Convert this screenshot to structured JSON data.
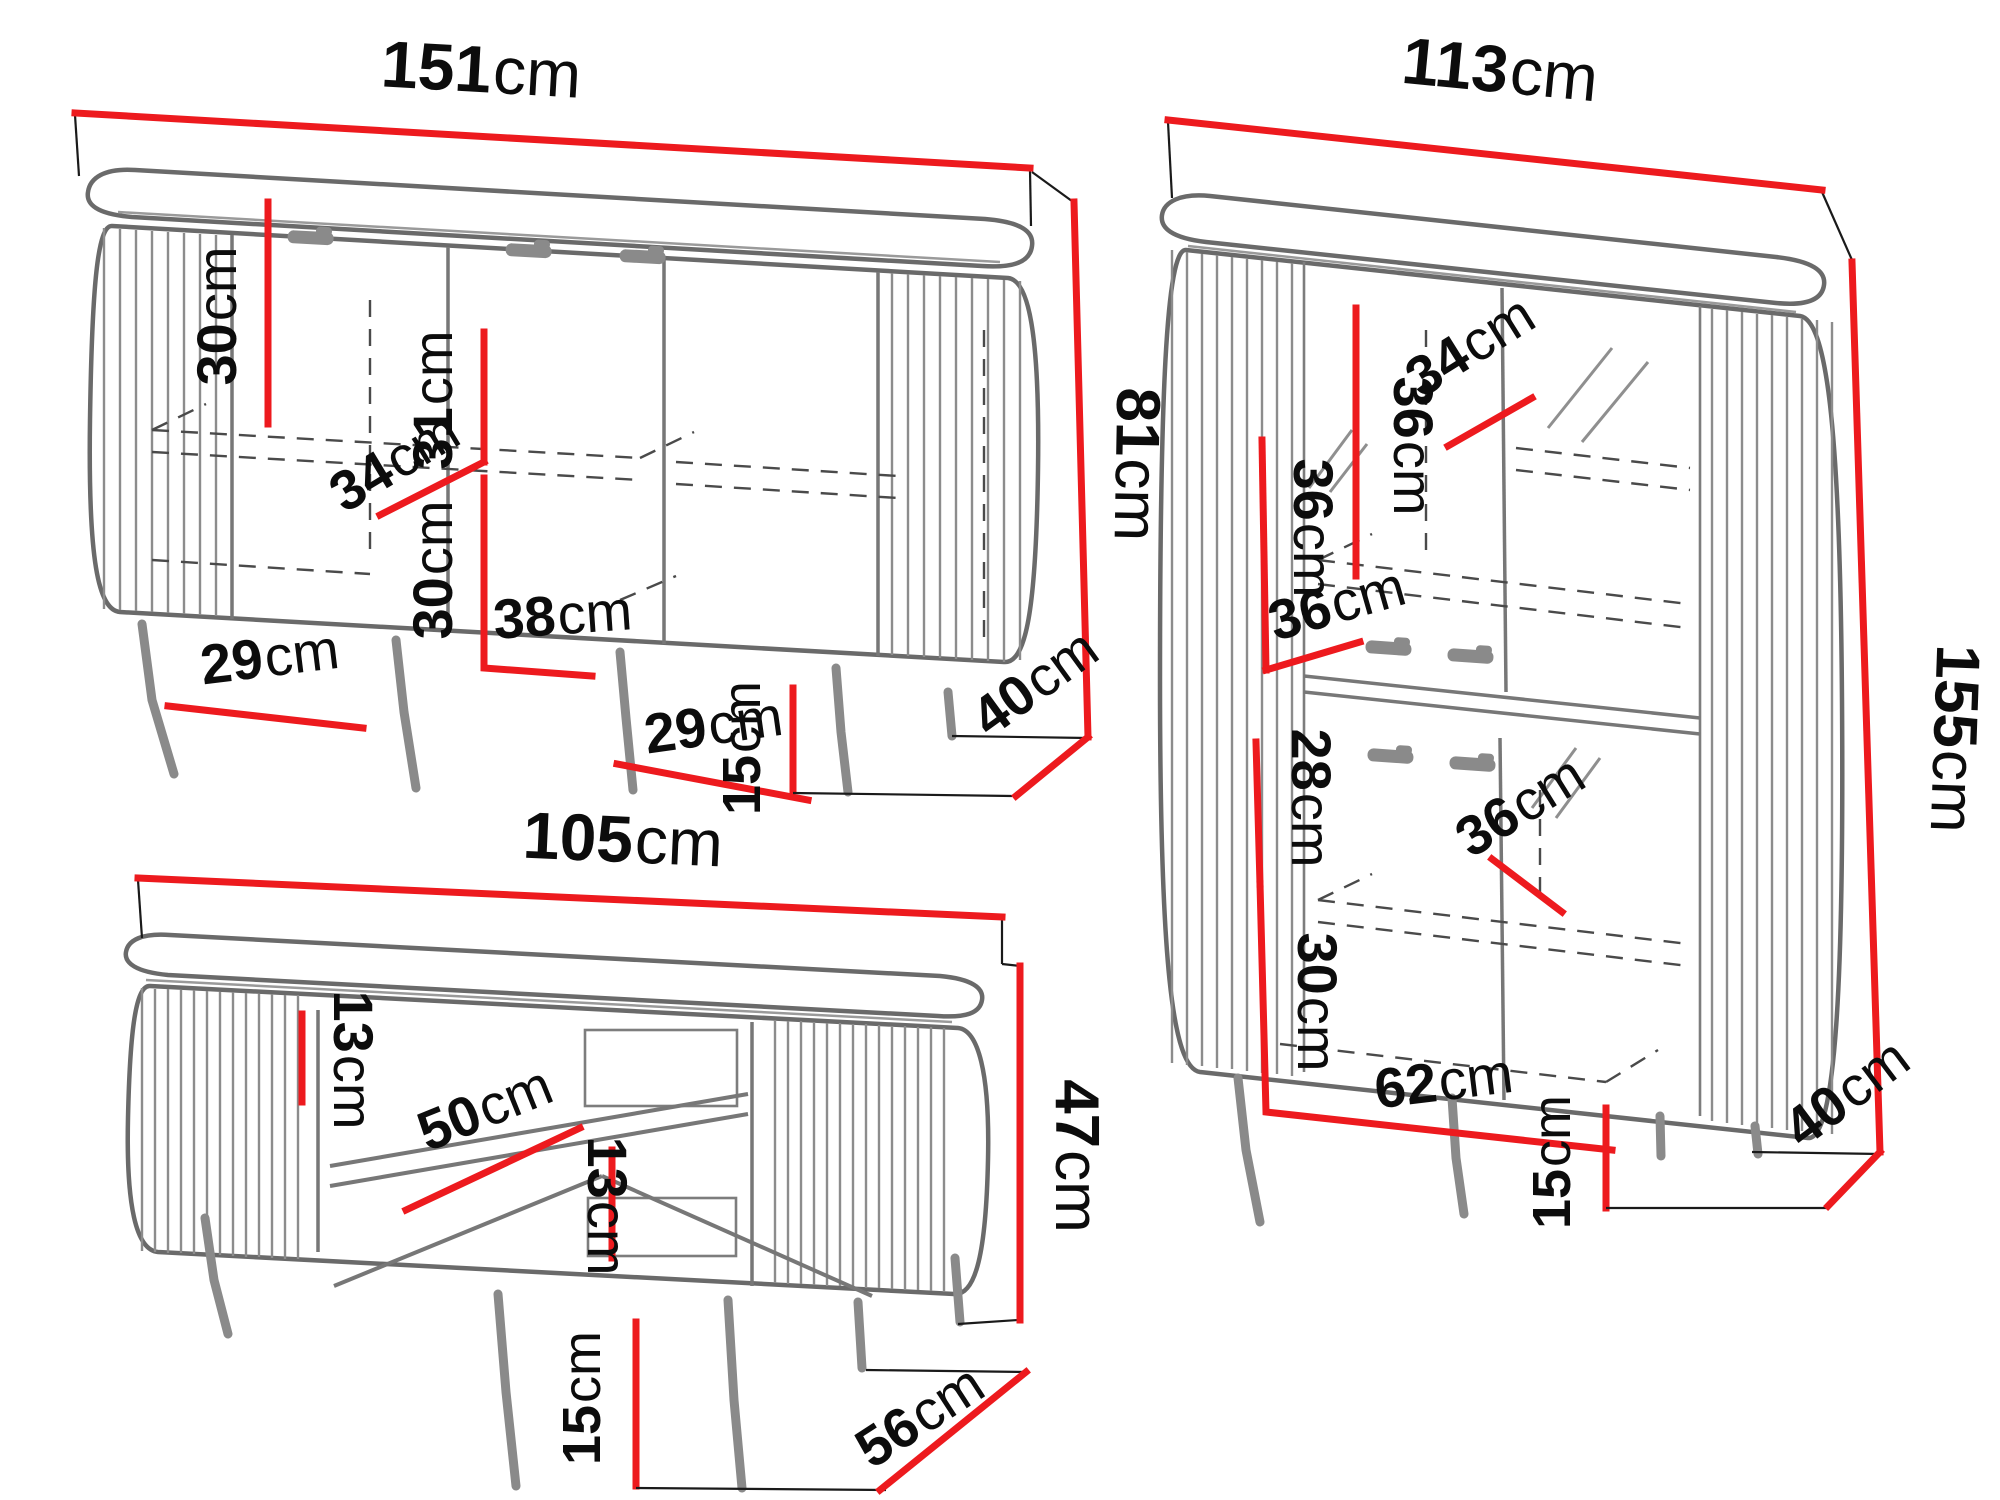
{
  "palette": {
    "dimension_red": "#ed1a1e",
    "furniture_line_gray": "#6a6a6a",
    "text_black": "#0c0c0c",
    "background": "#ffffff"
  },
  "unit": "cm",
  "furniture": {
    "sideboard": {
      "dims": {
        "width": {
          "v": "151",
          "u": "cm"
        },
        "inner_height_top": {
          "v": "30",
          "u": "cm"
        },
        "door_height": {
          "v": "31",
          "u": "cm"
        },
        "shelf_depth": {
          "v": "34",
          "u": "cm"
        },
        "inner_height_bottom": {
          "v": "30",
          "u": "cm"
        },
        "inner_width_center": {
          "v": "38",
          "u": "cm"
        },
        "inner_width_left": {
          "v": "29",
          "u": "cm"
        },
        "inner_width_right": {
          "v": "29",
          "u": "cm"
        },
        "body_height": {
          "v": "81",
          "u": "cm"
        },
        "leg_height": {
          "v": "15",
          "u": "cm"
        },
        "depth": {
          "v": "40",
          "u": "cm"
        }
      }
    },
    "cabinet": {
      "dims": {
        "width": {
          "v": "113",
          "u": "cm"
        },
        "inner_height_top": {
          "v": "36",
          "u": "cm"
        },
        "shelf_depth_top": {
          "v": "34",
          "u": "cm"
        },
        "inner_height_mid": {
          "v": "36",
          "u": "cm"
        },
        "shelf_depth_mid": {
          "v": "36",
          "u": "cm"
        },
        "inner_height_lower_top": {
          "v": "28",
          "u": "cm"
        },
        "shelf_depth_lower": {
          "v": "36",
          "u": "cm"
        },
        "inner_height_lower_bottom": {
          "v": "30",
          "u": "cm"
        },
        "inner_width_bottom": {
          "v": "62",
          "u": "cm"
        },
        "height": {
          "v": "155",
          "u": "cm"
        },
        "leg_height": {
          "v": "15",
          "u": "cm"
        },
        "depth": {
          "v": "40",
          "u": "cm"
        }
      }
    },
    "table": {
      "dims": {
        "width": {
          "v": "105",
          "u": "cm"
        },
        "niche_height_top": {
          "v": "13",
          "u": "cm"
        },
        "shelf_depth": {
          "v": "50",
          "u": "cm"
        },
        "niche_height_bottom": {
          "v": "13",
          "u": "cm"
        },
        "height": {
          "v": "47",
          "u": "cm"
        },
        "leg_height": {
          "v": "15",
          "u": "cm"
        },
        "depth": {
          "v": "56",
          "u": "cm"
        }
      }
    }
  }
}
